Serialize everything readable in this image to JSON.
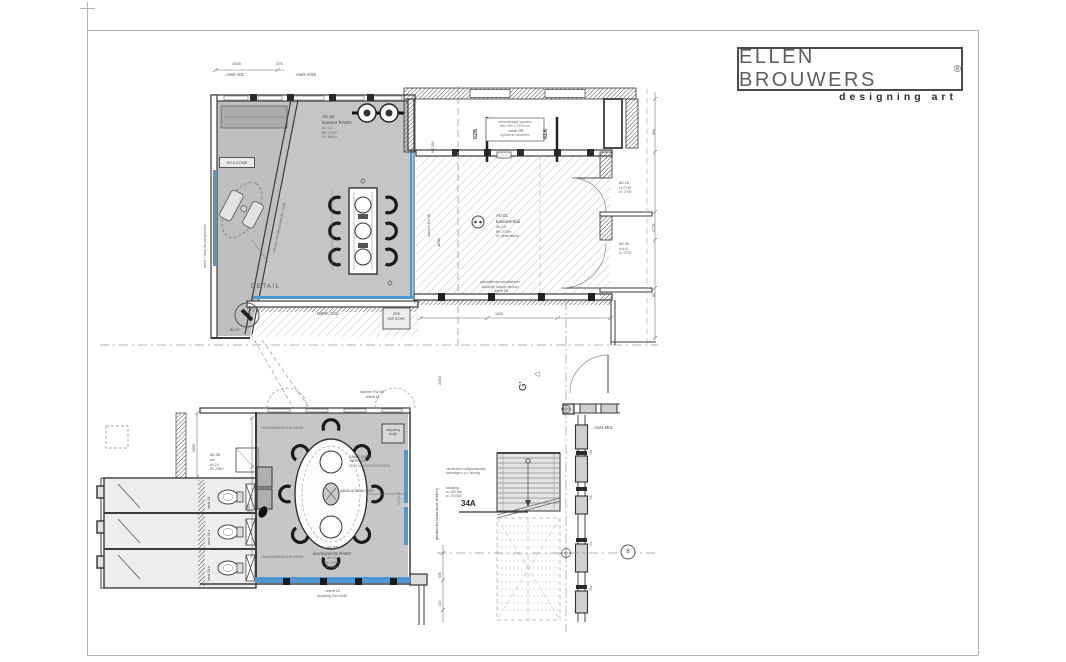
{
  "logo": {
    "name": "ELLEN BROUWERS",
    "reg": "®",
    "tagline": "designing art"
  },
  "upper_plan": {
    "dim_a": "1945",
    "dim_b": "375",
    "mark_a01": ". merk A01",
    "mark_a02s": ". merk A02s",
    "office_lines": [
      "A0.18",
      "kantoor RABO",
      "Ah 2,6",
      "BK 2700+",
      "VL 1600+"
    ],
    "zone_tag": "EV.A ZONE",
    "note_left_wall": "wcd's + data tbv werkplekken",
    "note_diag": "nieuwe scheidingswand Rw 43dB",
    "detail": "DETAIL",
    "merk_g02": "MERK G02",
    "cab_box": [
      "GRK",
      "ONTSCHR."
    ],
    "b107": "B1.07",
    "axis_62b": "62B",
    "axis_62a": "62A",
    "gr_box": [
      "scharnierzijde wisselen",
      "afm. 990 x 2315 mm",
      ". merk GR",
      "signaleren afwerken"
    ],
    "hall_lines": [
      "A0.01",
      "kantorenhal",
      "Ah 2,6",
      "BK 2700+",
      "VL (thermisch)"
    ],
    "hall_bottom": [
      "zelfsluitende schuifdeuren",
      "automat. naloop deuren",
      ". merk 16"
    ],
    "a016_lines": [
      "A0.16",
      "l.k C+W",
      "h= 2700"
    ],
    "a029_lines": [
      "A0.29",
      "m.k B",
      "h= 2700"
    ],
    "dims_right": [
      "904",
      "1775",
      "85"
    ],
    "note_hall_wall": "wanden Rw NB",
    "dim_hall": "4630",
    "dim_small": "100 150",
    "dim_1425": "1425"
  },
  "middle": {
    "axis_g": "G'",
    "pointer": "◁",
    "dim": "2053",
    "merk_m01": ". merk M01"
  },
  "lower_plan": {
    "top_note": [
      "wanden Rw NB",
      ". merk 17"
    ],
    "armatuur": "WANDARMATUUR 2400H",
    "wc_lines": [
      "A0.38",
      "wc",
      "Ah 2,6",
      "BK 2080+"
    ],
    "toilet_marks": [
      "merk 24",
      "merk 24 a",
      "merk 24 b"
    ],
    "table_note": [
      "CABLE CUBBY",
      "TAFELBOX",
      "DKW (VLOERDOORVOER)"
    ],
    "aansluit": "AANSLUITBLAD WCD",
    "aansluit_h": "h=750+vl",
    "meeting_lines": [
      "A0.37",
      "overlegruimte RABO",
      "Ah 2,6",
      "BK 2700+",
      "VL 1600+"
    ],
    "bottom_note": [
      ". merk 23",
      "beplating Rw=43dB"
    ],
    "uitsparing": [
      "uitsparing",
      "kozijn"
    ],
    "stair_label": "34A",
    "stair_note1": [
      "hernieuwen veiligheidsstrips",
      "bevestigen t.p.v. leuning"
    ],
    "stair_note2": [
      "belasting",
      "b= 180 mm",
      "a= 250/300"
    ],
    "garderobe": "garderobe (kast door derden)",
    "axis_8": "8",
    "window_labels": [
      "53a",
      "53b",
      "53c",
      "53d"
    ],
    "dim_2690": "2690",
    "dim_3050": "3050",
    "dim_645": "645",
    "dim_300": "300"
  },
  "colors": {
    "highlight": "#4f97d4"
  }
}
